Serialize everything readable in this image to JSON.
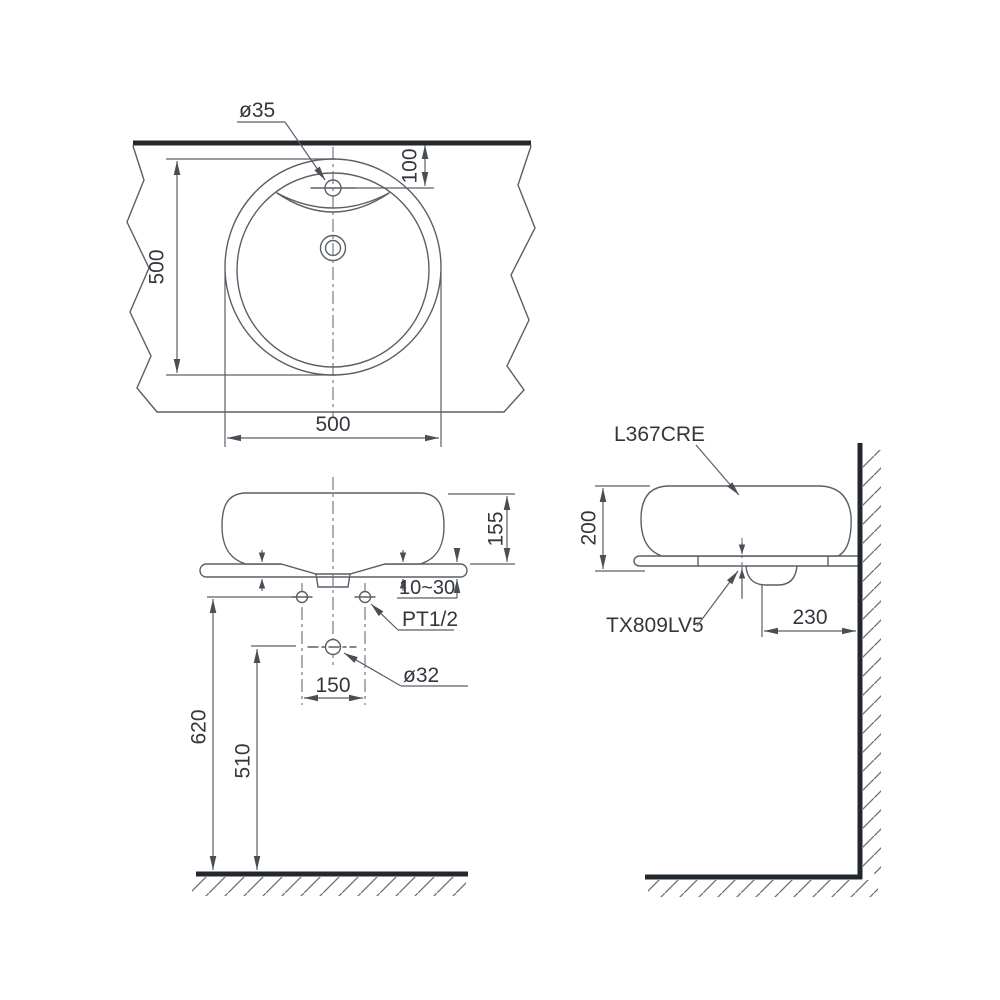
{
  "drawing": {
    "views": {
      "plan": {
        "labels": {
          "faucet_hole": "ø35"
        },
        "dims": {
          "faucet_center_from_edge": "100",
          "bowl_depth": "500",
          "bowl_width": "500"
        }
      },
      "front": {
        "labels": {
          "supply_thread": "PT1/2",
          "drain_hole": "ø32"
        },
        "dims": {
          "basin_height_above_counter": "155",
          "counter_thickness_range": "10~30",
          "supply_hole_spacing": "150",
          "supply_height_from_floor": "620",
          "drain_height_from_floor": "510"
        }
      },
      "side": {
        "labels": {
          "basin_model": "L367CRE",
          "drain_fitting_model": "TX809LV5"
        },
        "dims": {
          "basin_total_height": "200",
          "drain_center_to_wall": "230"
        }
      }
    },
    "colors": {
      "line": "#5a5f66",
      "thick_line": "#23272e",
      "text": "#33373c",
      "background": "#ffffff"
    }
  }
}
